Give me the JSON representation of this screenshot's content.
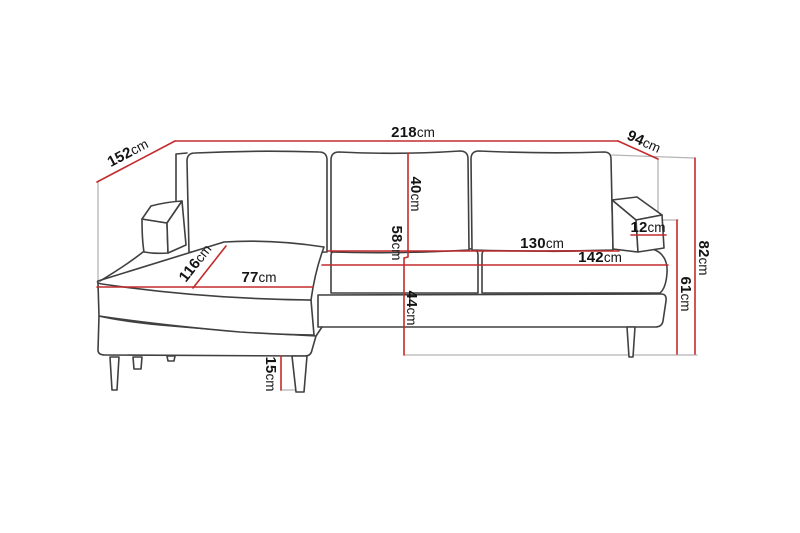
{
  "diagram": {
    "type": "furniture-dimension-drawing",
    "subject": "corner sofa with chaise longue",
    "unit": "cm"
  },
  "colors": {
    "dimension_line": "#c42b2b",
    "sofa_outline": "#404040",
    "construction_line": "#b5b5b5",
    "label_text": "#141414",
    "background": "#ffffff"
  },
  "dimensions": {
    "total_width": {
      "value": "218",
      "unit": "cm"
    },
    "chaise_depth": {
      "value": "152",
      "unit": "cm"
    },
    "total_depth": {
      "value": "94",
      "unit": "cm"
    },
    "back_cushion_height": {
      "value": "40",
      "unit": "cm"
    },
    "seat_back_height": {
      "value": "58",
      "unit": "cm"
    },
    "seat_height": {
      "value": "44",
      "unit": "cm"
    },
    "armrest_width": {
      "value": "12",
      "unit": "cm"
    },
    "total_height": {
      "value": "82",
      "unit": "cm"
    },
    "armrest_height": {
      "value": "61",
      "unit": "cm"
    },
    "inner_seat_width": {
      "value": "130",
      "unit": "cm"
    },
    "seat_width": {
      "value": "142",
      "unit": "cm"
    },
    "chaise_length": {
      "value": "116",
      "unit": "cm"
    },
    "chaise_seat_width": {
      "value": "77",
      "unit": "cm"
    },
    "leg_height": {
      "value": "15",
      "unit": "cm"
    }
  }
}
